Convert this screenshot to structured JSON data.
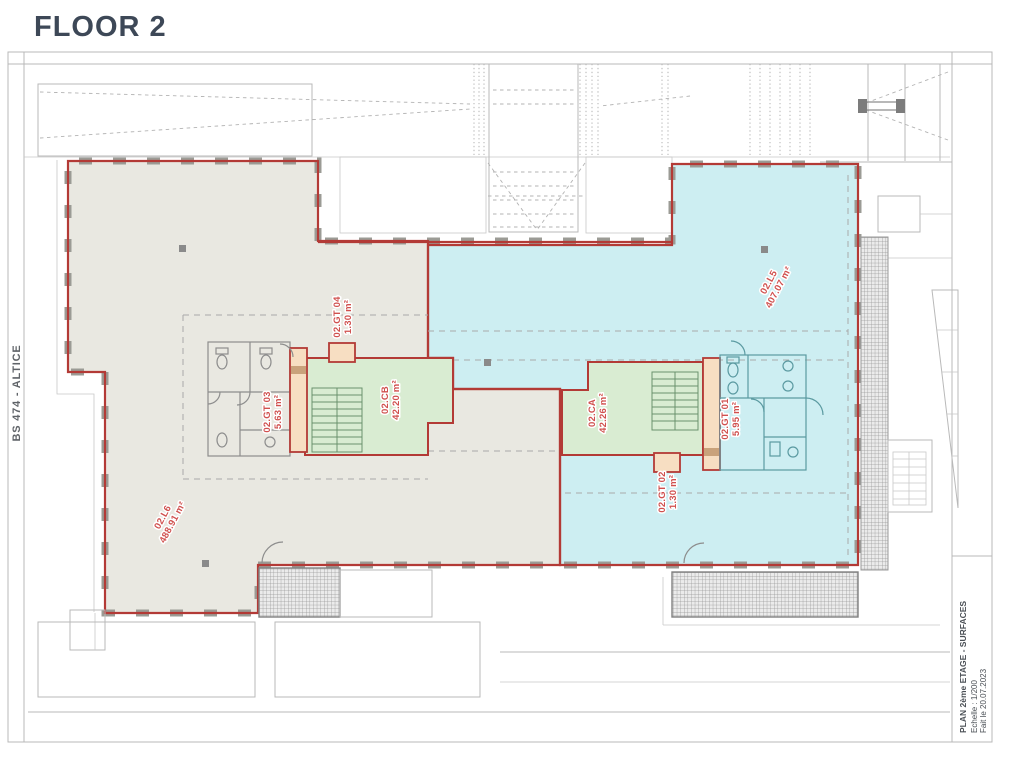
{
  "page_title": "FLOOR 2",
  "side_label": "BS 474 - ALTICE",
  "title_block": {
    "line1": "PLAN 2ème ETAGE - SURFACES",
    "line2": "Echelle : 1/200",
    "line3": "Fait le 20.07.2023"
  },
  "rooms": [
    {
      "id": "02.L6",
      "area": "488.91 m²",
      "zone": "left-open-space"
    },
    {
      "id": "02.L5",
      "area": "407.07 m²",
      "zone": "right-open-space"
    },
    {
      "id": "02.CB",
      "area": "42.20 m²",
      "zone": "left-stair-core"
    },
    {
      "id": "02.CA",
      "area": "42.26 m²",
      "zone": "right-stair-core"
    },
    {
      "id": "02.GT 03",
      "area": "5.63 m²",
      "zone": "left-shaft"
    },
    {
      "id": "02.GT 04",
      "area": "1.30 m²",
      "zone": "left-small-shaft"
    },
    {
      "id": "02.GT 01",
      "area": "5.95 m²",
      "zone": "right-shaft"
    },
    {
      "id": "02.GT 02",
      "area": "1.30 m²",
      "zone": "right-small-shaft"
    }
  ],
  "colors": {
    "wall_red": "#b33a36",
    "label_red": "#d0504e",
    "zone_left_fill": "#e9e8e1",
    "zone_right_fill": "#cdeef2",
    "stair_room_green": "#d9ecd2",
    "shaft_orange": "#f7dec2",
    "title_text": "#3d4857"
  }
}
